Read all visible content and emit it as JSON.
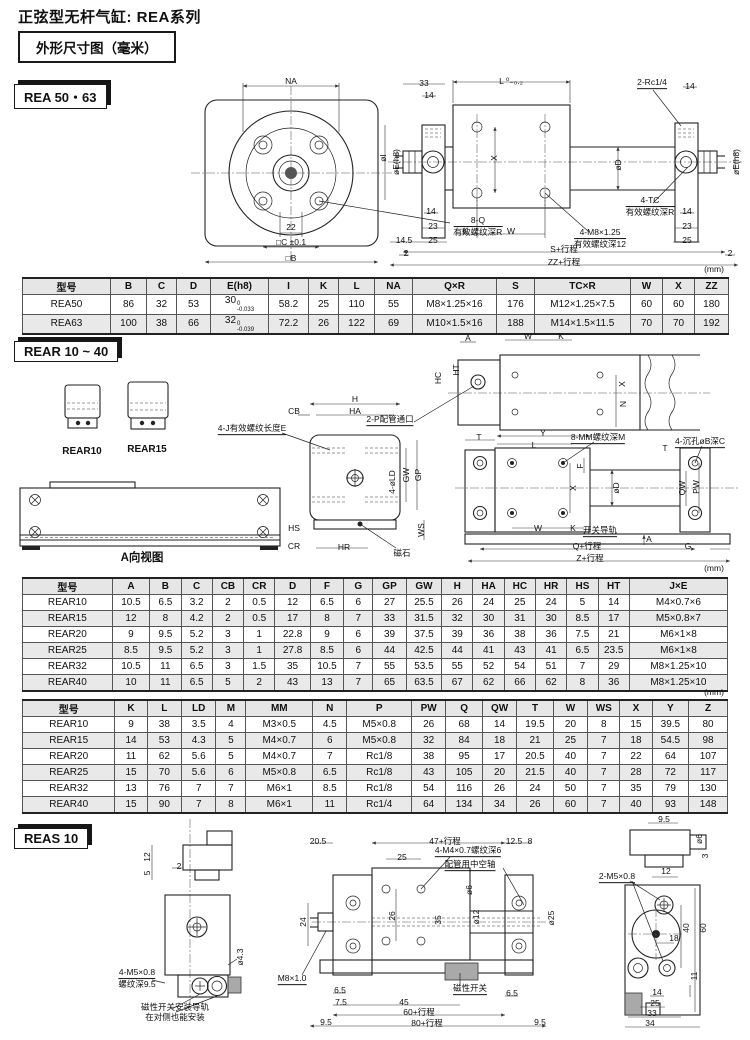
{
  "page": {
    "title": "正弦型无杆气缸: REA系列",
    "spec_box": "外形尺寸图（毫米）"
  },
  "tabs": {
    "rea": "REA 50・63",
    "rear": "REAR 10 ~ 40",
    "reas": "REAS 10"
  },
  "tables": {
    "rea": {
      "headers": [
        "型号",
        "B",
        "C",
        "D",
        "E(h8)",
        "I",
        "K",
        "L",
        "NA",
        "Q×R",
        "S",
        "TC×R",
        "W",
        "X",
        "ZZ"
      ],
      "rows": [
        [
          "REA50",
          "86",
          "32",
          "53",
          {
            "b": "30",
            "sup": "0",
            "sub": "-0.033"
          },
          "58.2",
          "25",
          "110",
          "55",
          "M8×1.25×16",
          "176",
          "M12×1.25×7.5",
          "60",
          "60",
          "180"
        ],
        [
          "REA63",
          "100",
          "38",
          "66",
          {
            "b": "32",
            "sup": "0",
            "sub": "-0.039"
          },
          "72.2",
          "26",
          "122",
          "69",
          "M10×1.5×16",
          "188",
          "M14×1.5×11.5",
          "70",
          "70",
          "192"
        ]
      ]
    },
    "rear_a": {
      "headers": [
        "型号",
        "A",
        "B",
        "C",
        "CB",
        "CR",
        "D",
        "F",
        "G",
        "GP",
        "GW",
        "H",
        "HA",
        "HC",
        "HR",
        "HS",
        "HT",
        "J×E"
      ],
      "rows": [
        [
          "REAR10",
          "10.5",
          "6.5",
          "3.2",
          "2",
          "0.5",
          "12",
          "6.5",
          "6",
          "27",
          "25.5",
          "26",
          "24",
          "25",
          "24",
          "5",
          "14",
          "M4×0.7×6"
        ],
        [
          "REAR15",
          "12",
          "8",
          "4.2",
          "2",
          "0.5",
          "17",
          "8",
          "7",
          "33",
          "31.5",
          "32",
          "30",
          "31",
          "30",
          "8.5",
          "17",
          "M5×0.8×7"
        ],
        [
          "REAR20",
          "9",
          "9.5",
          "5.2",
          "3",
          "1",
          "22.8",
          "9",
          "6",
          "39",
          "37.5",
          "39",
          "36",
          "38",
          "36",
          "7.5",
          "21",
          "M6×1×8"
        ],
        [
          "REAR25",
          "8.5",
          "9.5",
          "5.2",
          "3",
          "1",
          "27.8",
          "8.5",
          "6",
          "44",
          "42.5",
          "44",
          "41",
          "43",
          "41",
          "6.5",
          "23.5",
          "M6×1×8"
        ],
        [
          "REAR32",
          "10.5",
          "11",
          "6.5",
          "3",
          "1.5",
          "35",
          "10.5",
          "7",
          "55",
          "53.5",
          "55",
          "52",
          "54",
          "51",
          "7",
          "29",
          "M8×1.25×10"
        ],
        [
          "REAR40",
          "10",
          "11",
          "6.5",
          "5",
          "2",
          "43",
          "13",
          "7",
          "65",
          "63.5",
          "67",
          "62",
          "66",
          "62",
          "8",
          "36",
          "M8×1.25×10"
        ]
      ]
    },
    "rear_b": {
      "headers": [
        "型号",
        "K",
        "L",
        "LD",
        "M",
        "MM",
        "N",
        "P",
        "PW",
        "Q",
        "QW",
        "T",
        "W",
        "WS",
        "X",
        "Y",
        "Z"
      ],
      "rows": [
        [
          "REAR10",
          "9",
          "38",
          "3.5",
          "4",
          "M3×0.5",
          "4.5",
          "M5×0.8",
          "26",
          "68",
          "14",
          "19.5",
          "20",
          "8",
          "15",
          "39.5",
          "80"
        ],
        [
          "REAR15",
          "14",
          "53",
          "4.3",
          "5",
          "M4×0.7",
          "6",
          "M5×0.8",
          "32",
          "84",
          "18",
          "21",
          "25",
          "7",
          "18",
          "54.5",
          "98"
        ],
        [
          "REAR20",
          "11",
          "62",
          "5.6",
          "5",
          "M4×0.7",
          "7",
          "Rc1/8",
          "38",
          "95",
          "17",
          "20.5",
          "40",
          "7",
          "22",
          "64",
          "107"
        ],
        [
          "REAR25",
          "15",
          "70",
          "5.6",
          "6",
          "M5×0.8",
          "6.5",
          "Rc1/8",
          "43",
          "105",
          "20",
          "21.5",
          "40",
          "7",
          "28",
          "72",
          "117"
        ],
        [
          "REAR32",
          "13",
          "76",
          "7",
          "7",
          "M6×1",
          "8.5",
          "Rc1/8",
          "54",
          "116",
          "26",
          "24",
          "50",
          "7",
          "35",
          "79",
          "130"
        ],
        [
          "REAR40",
          "15",
          "90",
          "7",
          "8",
          "M6×1",
          "11",
          "Rc1/4",
          "64",
          "134",
          "34",
          "26",
          "60",
          "7",
          "40",
          "93",
          "148"
        ]
      ]
    }
  },
  "labels": {
    "rea": [
      {
        "t": "NA",
        "x": 291,
        "y": 81
      },
      {
        "t": "22",
        "x": 291,
        "y": 227
      },
      {
        "t": "□C ±0.1",
        "x": 291,
        "y": 242
      },
      {
        "t": "□B",
        "x": 291,
        "y": 258
      },
      {
        "t": "8-Q\n有效螺纹深R",
        "x": 478,
        "y": 226,
        "u": 1
      },
      {
        "t": "33",
        "x": 424,
        "y": 83
      },
      {
        "t": "14",
        "x": 429,
        "y": 95
      },
      {
        "t": "L ⁰₋₀.₂",
        "x": 511,
        "y": 81
      },
      {
        "t": "2-Rc1/4",
        "x": 652,
        "y": 83,
        "u": 1
      },
      {
        "t": "14",
        "x": 690,
        "y": 86
      },
      {
        "t": "øI",
        "x": 383,
        "y": 158,
        "r": 1
      },
      {
        "t": "øE(h8)",
        "x": 396,
        "y": 162,
        "r": 1
      },
      {
        "t": "X",
        "x": 494,
        "y": 158,
        "r": 1
      },
      {
        "t": "øD",
        "x": 618,
        "y": 165,
        "r": 1
      },
      {
        "t": "øE(h8)",
        "x": 736,
        "y": 162,
        "r": 1
      },
      {
        "t": "14",
        "x": 431,
        "y": 211
      },
      {
        "t": "23",
        "x": 433,
        "y": 226
      },
      {
        "t": "25",
        "x": 433,
        "y": 240
      },
      {
        "t": "14.5",
        "x": 404,
        "y": 240
      },
      {
        "t": "2",
        "x": 406,
        "y": 253
      },
      {
        "t": "K",
        "x": 465,
        "y": 231
      },
      {
        "t": "W",
        "x": 511,
        "y": 231
      },
      {
        "t": "4-M8×1.25\n有效螺纹深12",
        "x": 600,
        "y": 238,
        "u": 1
      },
      {
        "t": "4-TC\n有效螺纹深R",
        "x": 650,
        "y": 206,
        "u": 1
      },
      {
        "t": "14",
        "x": 687,
        "y": 211
      },
      {
        "t": "23",
        "x": 687,
        "y": 226
      },
      {
        "t": "25",
        "x": 687,
        "y": 240
      },
      {
        "t": "2",
        "x": 730,
        "y": 253
      },
      {
        "t": "S+行程",
        "x": 564,
        "y": 249
      },
      {
        "t": "ZZ+行程",
        "x": 564,
        "y": 262
      },
      {
        "t": "(mm)",
        "x": 714,
        "y": 269
      }
    ],
    "rear": [
      {
        "t": "REAR10",
        "x": 82,
        "y": 452,
        "w": 1,
        "f": 10
      },
      {
        "t": "REAR15",
        "x": 147,
        "y": 450,
        "w": 1,
        "f": 10
      },
      {
        "t": "CB",
        "x": 294,
        "y": 411
      },
      {
        "t": "4-J有效螺纹长度E",
        "x": 252,
        "y": 429,
        "u": 1
      },
      {
        "t": "HS",
        "x": 294,
        "y": 528
      },
      {
        "t": "CR",
        "x": 294,
        "y": 546
      },
      {
        "t": "HR",
        "x": 344,
        "y": 547
      },
      {
        "t": "A向视图",
        "x": 142,
        "y": 559,
        "w": 1,
        "f": 11.5
      },
      {
        "t": "H",
        "x": 355,
        "y": 399
      },
      {
        "t": "HA",
        "x": 355,
        "y": 411
      },
      {
        "t": "GW",
        "x": 406,
        "y": 475,
        "r": 1
      },
      {
        "t": "GP",
        "x": 418,
        "y": 475,
        "r": 1
      },
      {
        "t": "4-øLD",
        "x": 392,
        "y": 482,
        "r": 1
      },
      {
        "t": "WS",
        "x": 421,
        "y": 530,
        "r": 1
      },
      {
        "t": "磁石",
        "x": 402,
        "y": 553
      },
      {
        "t": "A",
        "x": 468,
        "y": 338
      },
      {
        "t": "HT",
        "x": 456,
        "y": 370,
        "r": 1
      },
      {
        "t": "HC",
        "x": 438,
        "y": 378,
        "r": 1
      },
      {
        "t": "2-P配管通口",
        "x": 390,
        "y": 420,
        "u": 1
      },
      {
        "t": "W",
        "x": 528,
        "y": 336
      },
      {
        "t": "K",
        "x": 561,
        "y": 336
      },
      {
        "t": "X",
        "x": 622,
        "y": 384,
        "r": 1
      },
      {
        "t": "N",
        "x": 623,
        "y": 404,
        "r": 1
      },
      {
        "t": "T",
        "x": 479,
        "y": 437
      },
      {
        "t": "Y",
        "x": 543,
        "y": 433
      },
      {
        "t": "L",
        "x": 534,
        "y": 445
      },
      {
        "t": "8-MM螺纹深M",
        "x": 598,
        "y": 438,
        "u": 1
      },
      {
        "t": "4-沉孔øB深C",
        "x": 700,
        "y": 442,
        "u": 1
      },
      {
        "t": "T",
        "x": 665,
        "y": 448
      },
      {
        "t": "F",
        "x": 580,
        "y": 466,
        "r": 1
      },
      {
        "t": "øD",
        "x": 616,
        "y": 488,
        "r": 1
      },
      {
        "t": "X",
        "x": 573,
        "y": 488,
        "r": 1
      },
      {
        "t": "QW",
        "x": 682,
        "y": 488,
        "r": 1
      },
      {
        "t": "PW",
        "x": 696,
        "y": 487,
        "r": 1
      },
      {
        "t": "W",
        "x": 538,
        "y": 528
      },
      {
        "t": "K",
        "x": 573,
        "y": 528
      },
      {
        "t": "开关导轨",
        "x": 600,
        "y": 531,
        "u": 1
      },
      {
        "t": "Q+行程",
        "x": 587,
        "y": 546
      },
      {
        "t": "A",
        "x": 649,
        "y": 539
      },
      {
        "t": "G",
        "x": 688,
        "y": 546
      },
      {
        "t": "Z+行程",
        "x": 590,
        "y": 558
      },
      {
        "t": "(mm)",
        "x": 714,
        "y": 568
      },
      {
        "t": "(mm)",
        "x": 714,
        "y": 692
      }
    ],
    "reas": [
      {
        "t": "12",
        "x": 147,
        "y": 857,
        "r": 1
      },
      {
        "t": "5",
        "x": 147,
        "y": 873,
        "r": 1
      },
      {
        "t": "2",
        "x": 179,
        "y": 866
      },
      {
        "t": "ø4.3",
        "x": 240,
        "y": 957,
        "r": 1
      },
      {
        "t": "4-M5×0.8\n螺纹深9.5",
        "x": 137,
        "y": 978,
        "u": 1
      },
      {
        "t": "磁性开关安装导轨\n在对侧也能安装",
        "x": 175,
        "y": 1012
      },
      {
        "t": "20.5",
        "x": 318,
        "y": 841
      },
      {
        "t": "47+行程",
        "x": 445,
        "y": 841
      },
      {
        "t": "12.5",
        "x": 514,
        "y": 841
      },
      {
        "t": "8",
        "x": 530,
        "y": 841
      },
      {
        "t": "25",
        "x": 402,
        "y": 857
      },
      {
        "t": "4-M4×0.7螺纹深6",
        "x": 468,
        "y": 851,
        "u": 1
      },
      {
        "t": "配管用中空轴",
        "x": 470,
        "y": 865,
        "u": 1
      },
      {
        "t": "24",
        "x": 303,
        "y": 922,
        "r": 1
      },
      {
        "t": "26",
        "x": 392,
        "y": 916,
        "r": 1
      },
      {
        "t": "35",
        "x": 438,
        "y": 920,
        "r": 1
      },
      {
        "t": "ø6",
        "x": 469,
        "y": 890,
        "r": 1
      },
      {
        "t": "ø12",
        "x": 476,
        "y": 917,
        "r": 1
      },
      {
        "t": "ø25",
        "x": 551,
        "y": 918,
        "r": 1
      },
      {
        "t": "M8×1.0",
        "x": 292,
        "y": 979,
        "u": 1
      },
      {
        "t": "6.5",
        "x": 340,
        "y": 990
      },
      {
        "t": "7.5",
        "x": 341,
        "y": 1002
      },
      {
        "t": "45",
        "x": 404,
        "y": 1002
      },
      {
        "t": "磁性开关",
        "x": 470,
        "y": 989,
        "u": 1
      },
      {
        "t": "6.5",
        "x": 512,
        "y": 993
      },
      {
        "t": "60+行程",
        "x": 419,
        "y": 1012
      },
      {
        "t": "80+行程",
        "x": 427,
        "y": 1023
      },
      {
        "t": "9.5",
        "x": 326,
        "y": 1022
      },
      {
        "t": "9.5",
        "x": 540,
        "y": 1022
      },
      {
        "t": "9.5",
        "x": 664,
        "y": 819
      },
      {
        "t": "ø6",
        "x": 699,
        "y": 839,
        "r": 1
      },
      {
        "t": "3",
        "x": 705,
        "y": 856,
        "r": 1
      },
      {
        "t": "2-M5×0.8",
        "x": 617,
        "y": 877,
        "u": 1
      },
      {
        "t": "12",
        "x": 666,
        "y": 871
      },
      {
        "t": "40",
        "x": 686,
        "y": 928,
        "r": 1
      },
      {
        "t": "60",
        "x": 703,
        "y": 928,
        "r": 1
      },
      {
        "t": "18",
        "x": 674,
        "y": 938
      },
      {
        "t": "11",
        "x": 694,
        "y": 976,
        "r": 1
      },
      {
        "t": "14",
        "x": 657,
        "y": 992
      },
      {
        "t": "25",
        "x": 655,
        "y": 1003
      },
      {
        "t": "33",
        "x": 652,
        "y": 1013
      },
      {
        "t": "34",
        "x": 650,
        "y": 1023
      }
    ]
  }
}
